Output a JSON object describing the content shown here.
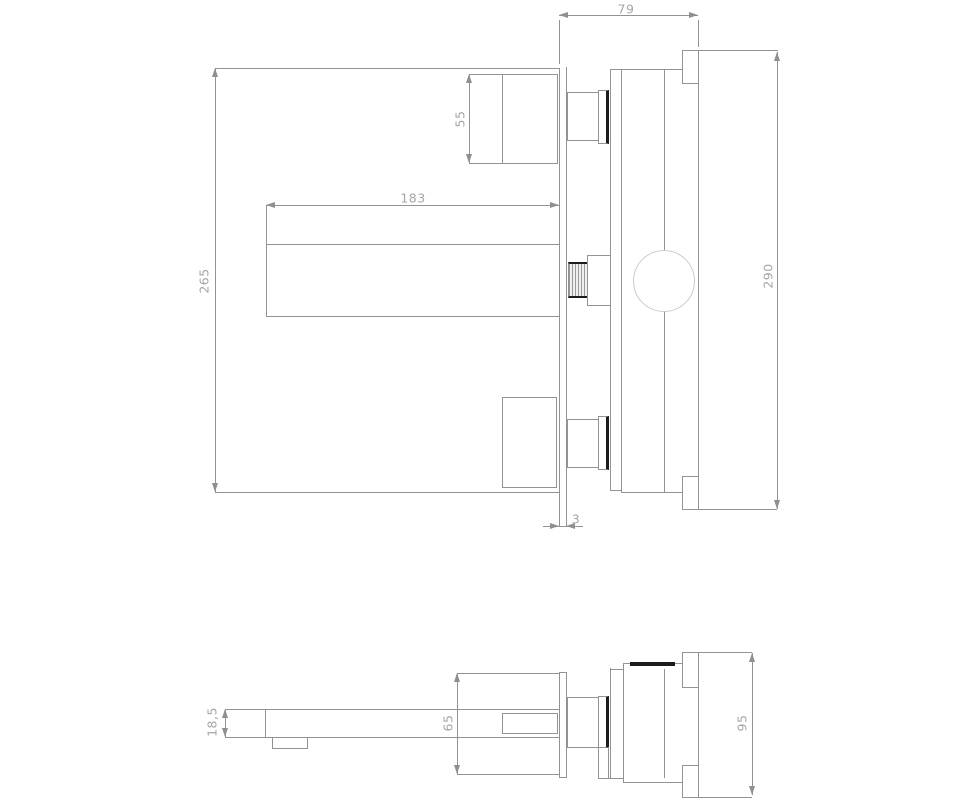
{
  "drawing": {
    "kind": "faucet-installation-technical-drawing",
    "views": [
      "front-section-view",
      "bottom-view"
    ]
  },
  "dimensions": {
    "body_depth": "79",
    "handle_height": "55",
    "spout_length": "183",
    "plate_height": "265",
    "body_height": "290",
    "plate_gap": "3",
    "spout_tip_height": "18,5",
    "handle_depth": "65",
    "body_width": "95"
  },
  "colors": {
    "background": "#ffffff",
    "line": "#939393",
    "dimension_text": "#a6a6a6",
    "accent_dark": "#1c1c1c",
    "circle": "#cbcbcb"
  }
}
